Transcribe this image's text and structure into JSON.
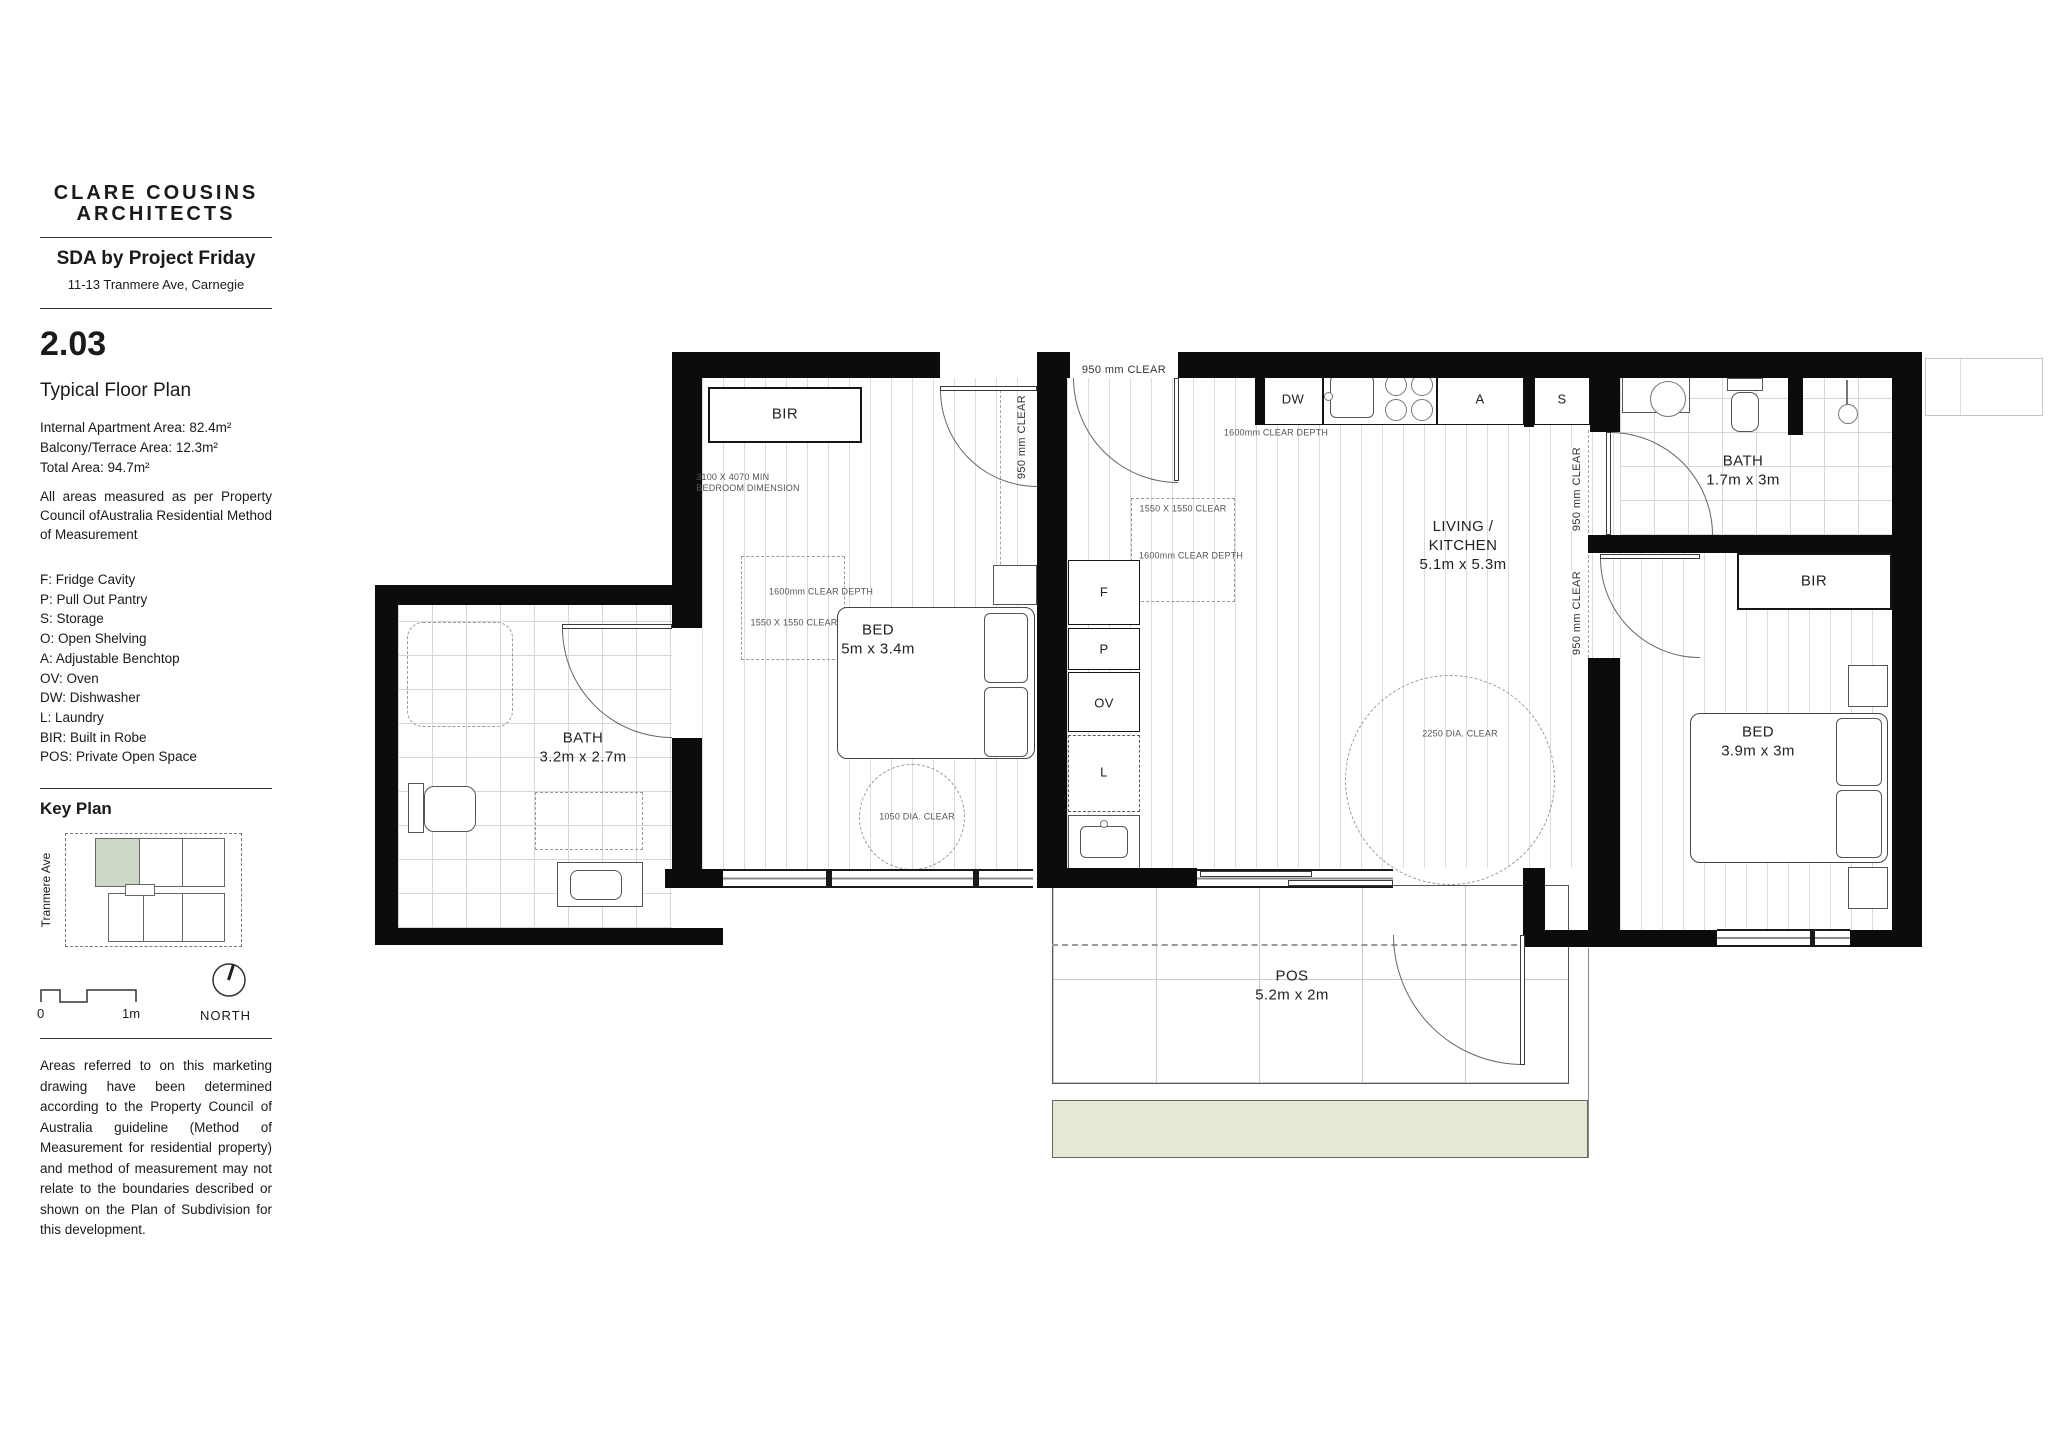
{
  "sidebar": {
    "logo_line1": "CLARE COUSINS",
    "logo_line2": "ARCHITECTS",
    "project_title": "SDA by Project Friday",
    "project_address": "11-13 Tranmere Ave, Carnegie",
    "sheet_number": "2.03",
    "sheet_title": "Typical Floor Plan",
    "areas": {
      "internal": "Internal Apartment Area: 82.4m²",
      "balcony": "Balcony/Terrace Area: 12.3m²",
      "total": "Total Area: 94.7m²"
    },
    "measurement_note": "All areas measured as per Property Council ofAustralia Residential Method of Measurement",
    "legend": [
      "F: Fridge Cavity",
      "P: Pull Out Pantry",
      "S: Storage",
      "O: Open Shelving",
      "A: Adjustable Benchtop",
      "OV: Oven",
      "DW: Dishwasher",
      "L: Laundry",
      "BIR: Built in Robe",
      "POS: Private Open Space"
    ],
    "key_plan": {
      "title": "Key Plan",
      "street": "Tranmere Ave"
    },
    "scale_bar": {
      "zero": "0",
      "one_m": "1m",
      "north": "NORTH"
    },
    "disclaimer": "Areas referred to on this marketing drawing have been determined according to the Property Council of Australia guideline (Method of Measurement for residential property) and method of measurement may not relate to the boundaries described or shown on the Plan of Subdivision for this development."
  },
  "plan": {
    "rooms": {
      "bed1": {
        "name": "BED",
        "dim": "5m x 3.4m"
      },
      "bed2": {
        "name": "BED",
        "dim": "3.9m x 3m"
      },
      "bath1": {
        "name": "BATH",
        "dim": "3.2m x 2.7m"
      },
      "bath2": {
        "name": "BATH",
        "dim": "1.7m x 3m"
      },
      "living": {
        "name1": "LIVING /",
        "name2": "KITCHEN",
        "dim": "5.1m x 5.3m"
      },
      "pos": {
        "name": "POS",
        "dim": "5.2m x 2m"
      }
    },
    "fixtures": {
      "bir": "BIR",
      "dw": "DW",
      "a": "A",
      "s": "S",
      "f": "F",
      "p": "P",
      "ov": "OV",
      "l": "L"
    },
    "annotations": {
      "clear950": "950 mm CLEAR",
      "bedroom_min1": "3100 X 4070 MIN",
      "bedroom_min2": "BEDROOM DIMENSION",
      "clear_depth1600": "1600mm CLEAR DEPTH",
      "clear1550": "1550 X 1550 CLEAR",
      "dia2250": "2250 DIA. CLEAR",
      "dia1050": "1050 DIA. CLEAR"
    },
    "colors": {
      "wall": "#0c0c0c",
      "garden": "#e4e9d6",
      "keyplan_highlight": "#ccd8c5"
    }
  }
}
